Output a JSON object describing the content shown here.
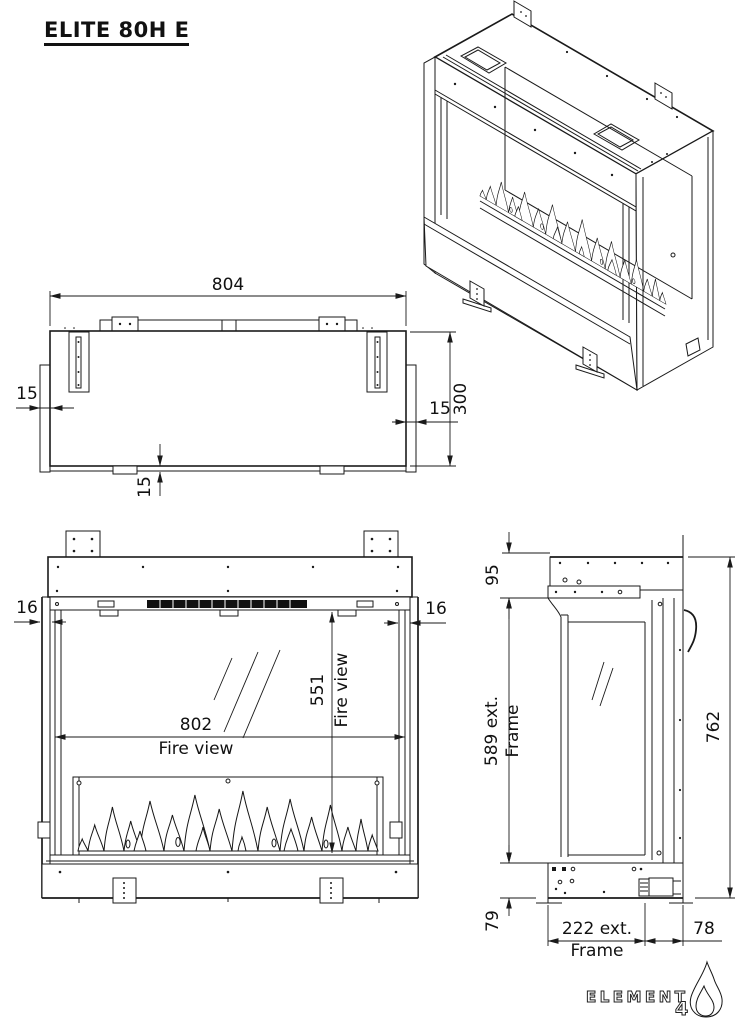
{
  "title": "ELITE 80H E",
  "views": {
    "top": {
      "width": "804",
      "depth": "300",
      "flange_left": "15",
      "flange_right": "15",
      "flange_bottom": "15"
    },
    "front": {
      "fire_width": "802",
      "fire_width_caption": "Fire view",
      "fire_height": "551",
      "fire_height_caption": "Fire view",
      "frame_left": "16",
      "frame_right": "16"
    },
    "side": {
      "top_offset": "95",
      "frame_height": "589 ext.",
      "frame_height_caption": "Frame",
      "total_height": "762",
      "bottom_offset": "79",
      "frame_depth": "222 ext.",
      "frame_depth_caption": "Frame",
      "rear_depth": "78"
    }
  },
  "logo": {
    "brand": "ELEMENT",
    "number": "4",
    "icon": "flame-icon"
  }
}
